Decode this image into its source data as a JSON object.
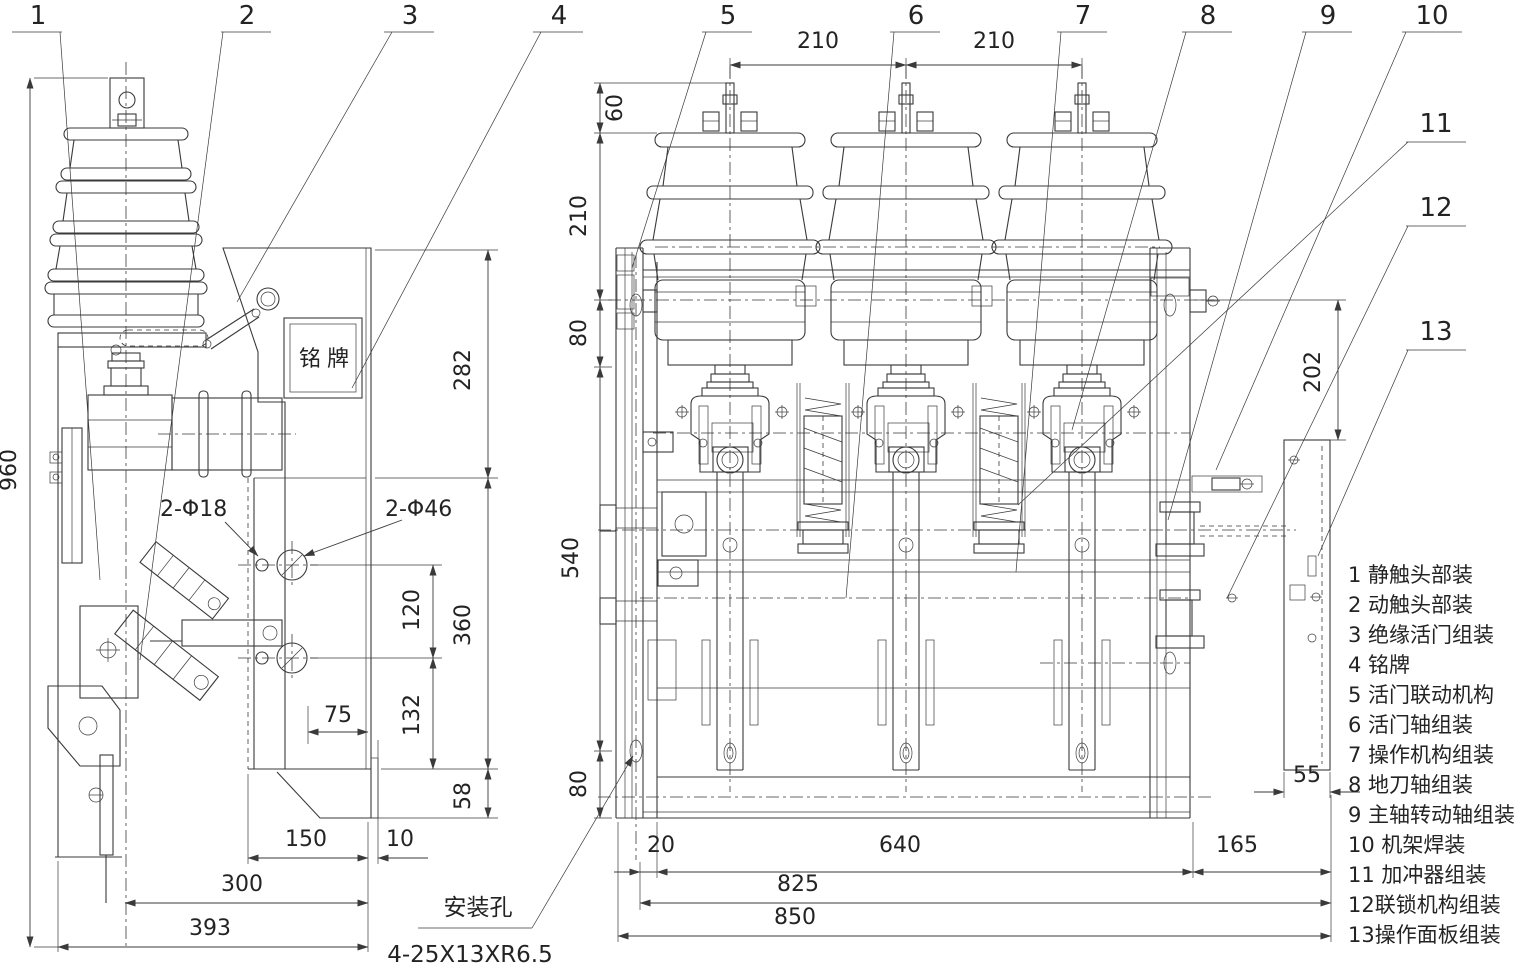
{
  "labels": {
    "nameplate": "铭牌",
    "mounting_hole": "安装孔",
    "mounting_slot_spec": "4-25X13XR6.5",
    "hole_18": "2-Φ18",
    "hole_46": "2-Φ46"
  },
  "dims_left": {
    "h960": "960",
    "h282": "282",
    "h360": "360",
    "h58": "58",
    "v120": "120",
    "v132": "132",
    "w75": "75",
    "w150": "150",
    "w10": "10",
    "w300": "300",
    "w393": "393"
  },
  "dims_right": {
    "top210a": "210",
    "top210b": "210",
    "v60": "60",
    "v210": "210",
    "v80t": "80",
    "v540": "540",
    "v80b": "80",
    "v202": "202",
    "w55": "55",
    "w20": "20",
    "w640": "640",
    "w165": "165",
    "w825": "825",
    "w850": "850"
  },
  "callouts": [
    "1",
    "2",
    "3",
    "4",
    "5",
    "6",
    "7",
    "8",
    "9",
    "10",
    "11",
    "12",
    "13"
  ],
  "legend": {
    "items": [
      "1 静触头部装",
      "2 动触头部装",
      "3 绝缘活门组装",
      "4 铭牌",
      "5 活门联动机构",
      "6 活门轴组装",
      "7 操作机构组装",
      "8 地刀轴组装",
      "9 主轴转动轴组装",
      "10 机架焊装",
      "11 加冲器组装",
      "12联锁机构组装",
      "13操作面板组装"
    ]
  }
}
